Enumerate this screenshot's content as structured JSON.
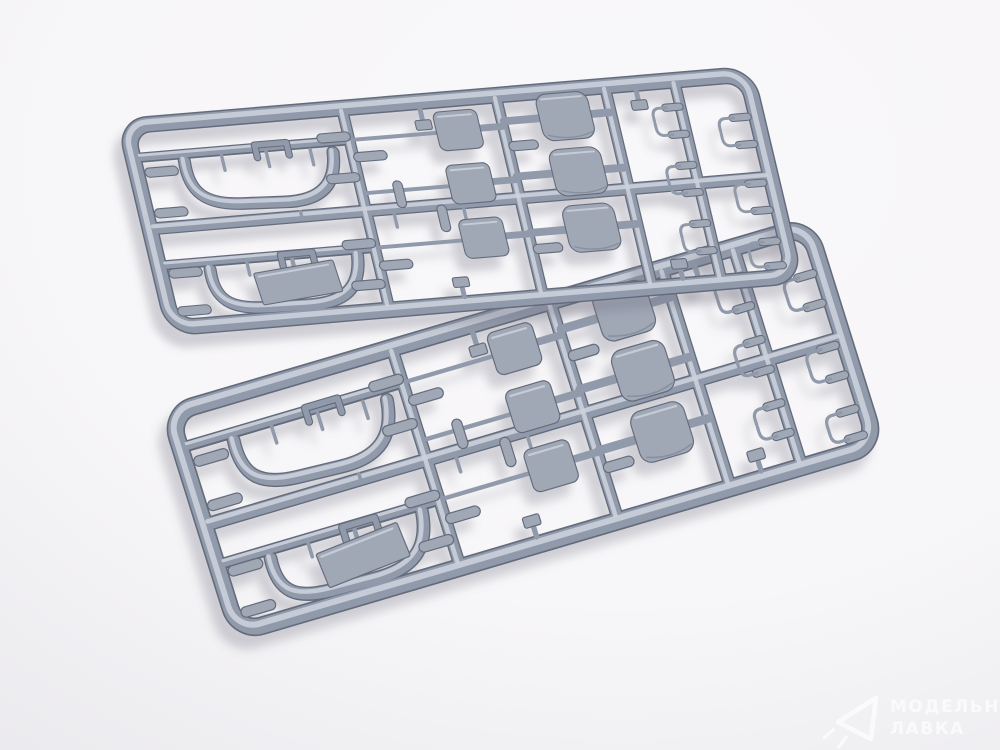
{
  "scene": {
    "type": "product-photo",
    "subject": "Two identical grey injection-molded plastic model kit sprues (runner frames with parts) lying crossed diagonally on a white studio background",
    "sprue_count": 2,
    "sprue_labels": [
      "sprue-top",
      "sprue-bottom"
    ]
  },
  "palette": {
    "bg_light": "#f8f7f9",
    "bg_shade": "#e9e8ec",
    "plastic_shadow": "#646c7c",
    "plastic_mid": "#919aaa",
    "plastic_highlight": "#ccd1dc",
    "part_fill": "#a0a8b6",
    "shadow_color": "#70707e",
    "watermark_color": "#ffffff"
  },
  "watermark": {
    "line1": "МОДЕЛЬНАЯ",
    "line2": "ЛАВКА",
    "logo": "paper-plane-triangle-icon"
  },
  "sprue_contents": {
    "description": "Each sprue holds the same set of vehicle-model parts",
    "rounded_seat_backs": 3,
    "flat_panels": 3,
    "curved_tube_frames": 2,
    "rectangular_plates": 1,
    "small_cylinder_parts": 12,
    "hook_bracket_parts": 12,
    "small_pins_and_gates": 10
  }
}
